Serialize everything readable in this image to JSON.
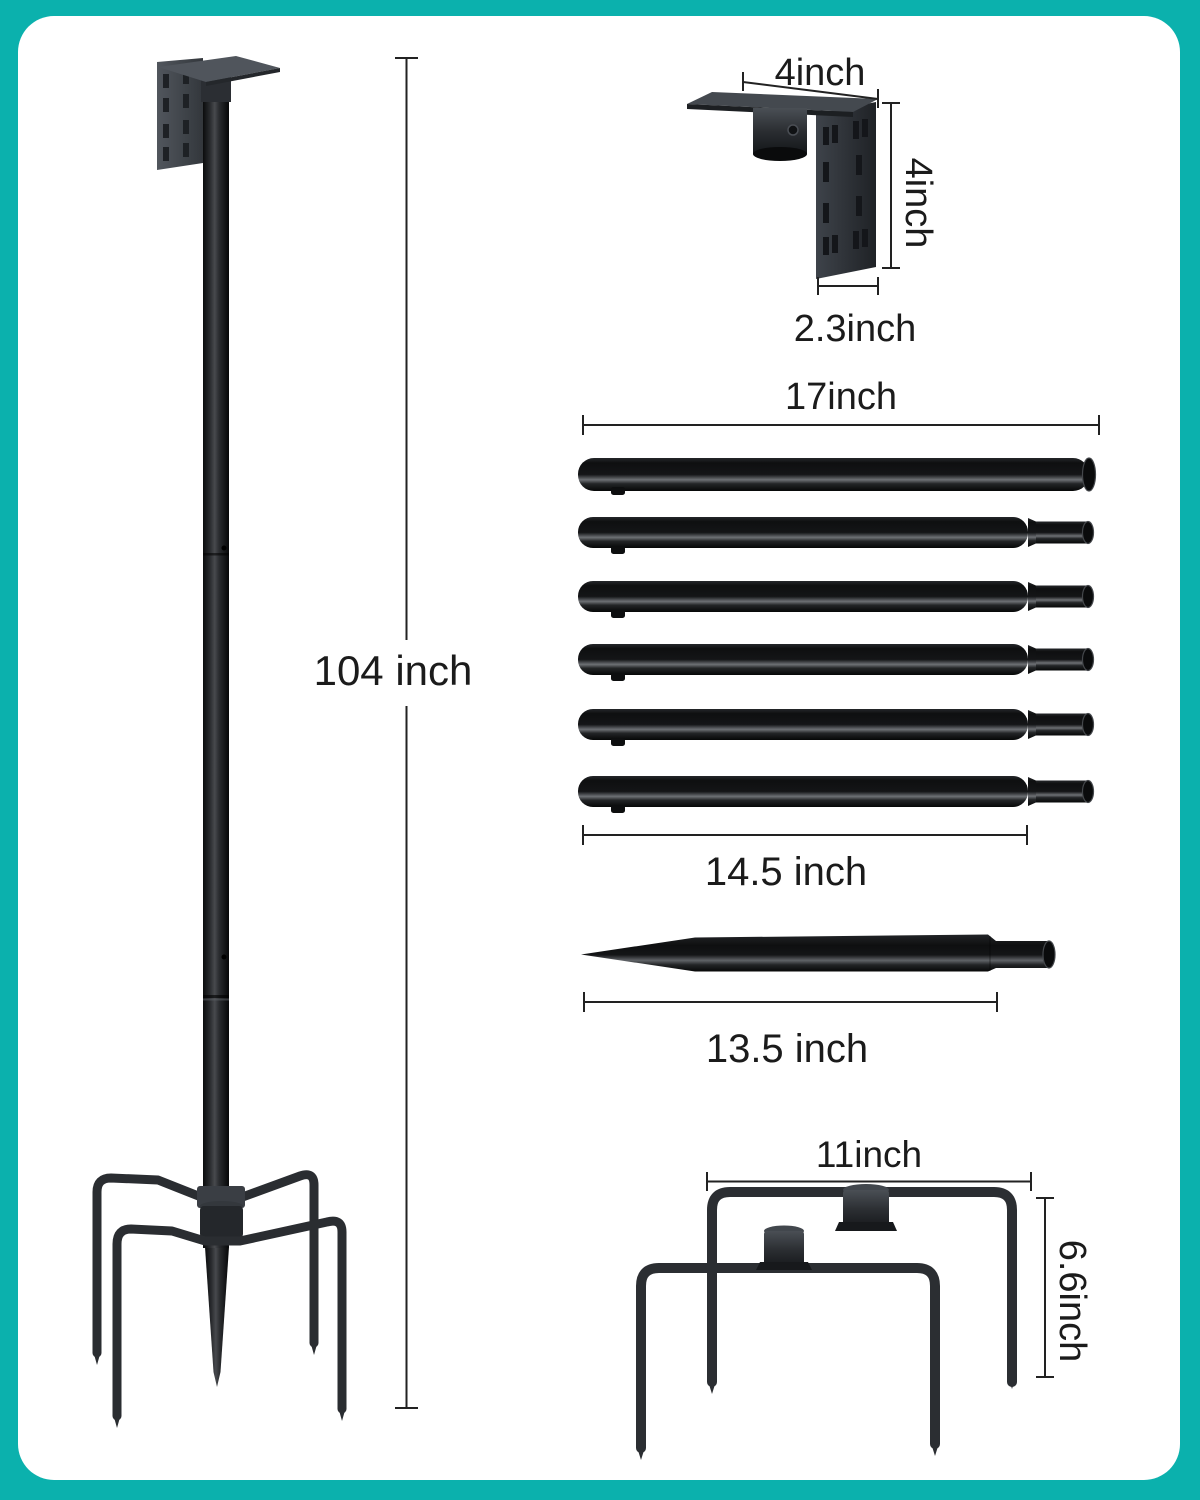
{
  "product_diagram": {
    "frame_color": "#0bb1ad",
    "card_color": "#ffffff",
    "dimension_line_color": "#222222",
    "product_color": "#17191b",
    "figures": {
      "assembled_pole": {
        "height_label": "104 inch"
      },
      "mounting_bracket": {
        "width_label": "4inch",
        "height_label": "4inch",
        "depth_label": "2.3inch"
      },
      "pole_tubes": {
        "count": 6,
        "full_length_label": "17inch",
        "body_length_label": "14.5 inch"
      },
      "ground_spike": {
        "length_label": "13.5 inch"
      },
      "five_prong_base": {
        "width_label": "11inch",
        "height_label": "6.6inch"
      }
    }
  }
}
